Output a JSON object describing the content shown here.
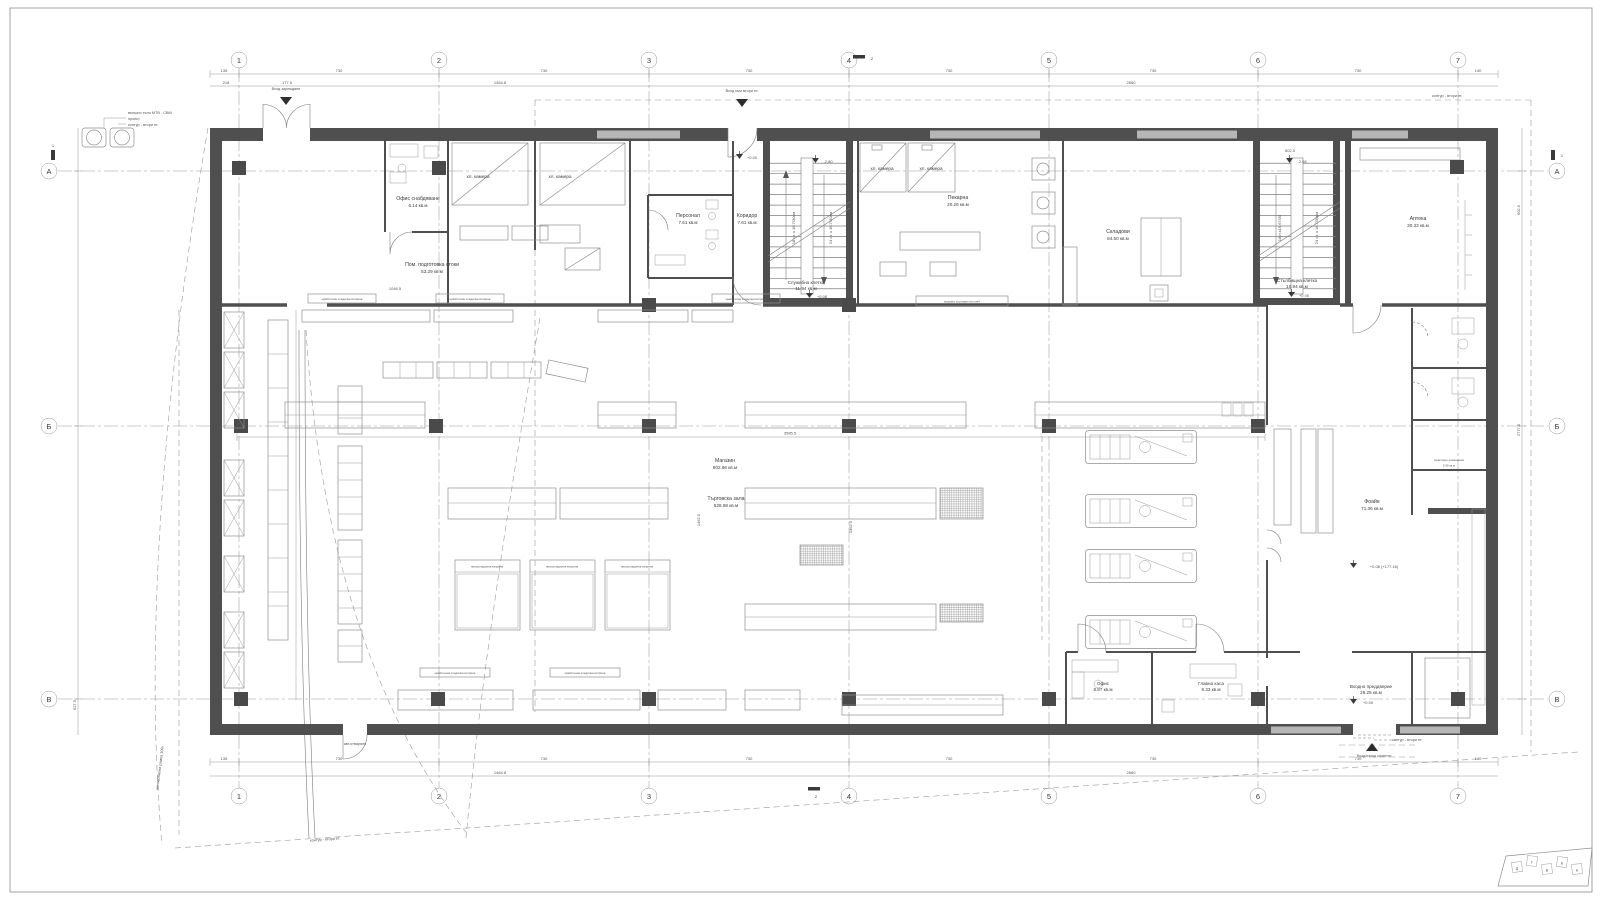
{
  "grid": {
    "cols": [
      "1",
      "2",
      "3",
      "4",
      "5",
      "6",
      "7"
    ],
    "rows": [
      "А",
      "Б",
      "В"
    ]
  },
  "section_markers": {
    "s1": "1",
    "s2": "2"
  },
  "entrances": [
    {
      "label": "Вход зареждане"
    },
    {
      "label": "Вход към втори ет."
    },
    {
      "label": "Вход/изход клиенти"
    }
  ],
  "rooms": [
    {
      "name": "Офис снабдяване",
      "area": "6.14 кв.м"
    },
    {
      "name": "Пом. подготовка стоки",
      "area": "53.29 кв.м"
    },
    {
      "name": "хл. камера"
    },
    {
      "name": "хл. камера"
    },
    {
      "name": "Персонал",
      "area": "7.61 кв.м"
    },
    {
      "name": "Коридор",
      "area": "7.61 кв.м"
    },
    {
      "name": "Служебна клетка",
      "area": "11.94 кв.м"
    },
    {
      "name": "хл. камера"
    },
    {
      "name": "хл. камера"
    },
    {
      "name": "Пекарна",
      "area": "20.26 кв.м"
    },
    {
      "name": "Складови",
      "area": "84.50 кв.м"
    },
    {
      "name": "Стълбищна клетка",
      "area": "10.94 кв.м"
    },
    {
      "name": "Аптека",
      "area": "30.33 кв.м"
    },
    {
      "name": "Магазин",
      "area": "802.86 кв.м"
    },
    {
      "name": "Търговска зала",
      "area": "528.98 кв.м"
    },
    {
      "name": "Фоайе",
      "area": "71.36 кв.м"
    },
    {
      "name": "санитарно помещение",
      "area": "5.96 кв.м"
    },
    {
      "name": "Офис",
      "area": "8.87 кв.м"
    },
    {
      "name": "Главна каса",
      "area": "9.33 кв.м"
    },
    {
      "name": "Входно преддверие",
      "area": "26.25 кв.м"
    }
  ],
  "stairs": {
    "a_left": "18 ст. x 16.7/30см",
    "a_right": "24 ст. x 16.7/30см",
    "b_left": "18ст.х16.67/30",
    "b_right": "24 ст. х 16.7/30см"
  },
  "elevations": [
    "+0.00",
    "-2.80",
    "+0.08",
    "-2.08",
    "+0.00",
    "+0.08 (+177.16)",
    "+0.00"
  ],
  "notes": [
    "външно тяло МТВ - СВМ",
    "проект",
    "контур - втори ет.",
    "автомобилна рампа 10%",
    "авт.отваряне"
  ],
  "fixtures": {
    "wall_case": "крайстенна хладилна витрина",
    "island_case": "нискохладилна витрина",
    "bread_slicer": "машина за рязане на хляб"
  },
  "dims": {
    "top1": [
      "135",
      "730",
      "730",
      "730",
      "730",
      "730",
      "730",
      "140"
    ],
    "top2": [
      "218",
      "177.5",
      "1464.8",
      "2660"
    ],
    "left": [
      "627.5"
    ],
    "right": [
      "2777.5",
      "602.5"
    ],
    "inner": [
      "3585.5",
      "1462.5",
      "1046.5",
      "602.5"
    ]
  },
  "key_plan": {
    "letters": [
      "Д",
      "Г",
      "В",
      "Б",
      "А"
    ]
  }
}
